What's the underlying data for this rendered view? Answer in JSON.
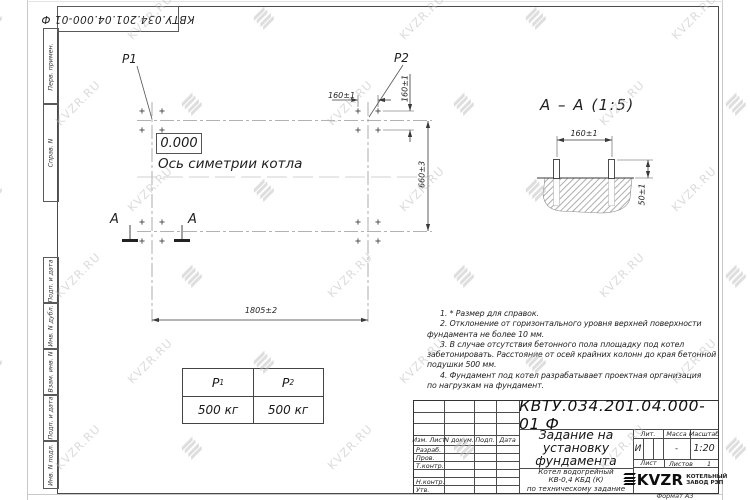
{
  "colors": {
    "paper": "#ffffff",
    "ink": "#3a3a3a",
    "centerline": "#999999",
    "watermark": "#bfbfbf"
  },
  "watermark": {
    "text": "KVZR.RU"
  },
  "edge_stamp": {
    "doc_number_rotated": "КВТУ.034.201.04.000-01 Ф"
  },
  "sidebar": {
    "labels": [
      "Перв. примен.",
      "Справ. N",
      "Подп. и дата",
      "Инв. N дубл.",
      "Взам. инв. N",
      "Подп. и дата",
      "Инв. N подл."
    ]
  },
  "plan_view": {
    "p1_label": "P1",
    "p2_label": "P2",
    "elevation": "0.000",
    "axis_label": "Ось симетрии котла",
    "dim_bolt_spacing_h": "160±1",
    "dim_bolt_spacing_v": "160±1",
    "dim_width": "660±3",
    "dim_length": "1805±2",
    "section_letter_left": "А",
    "section_letter_right": "А"
  },
  "section_view": {
    "title": "А – А (1:5)",
    "dim_bolt_spacing": "160±1",
    "dim_bolt_height": "50±1"
  },
  "notes_lines": [
    "1.  * Размер для справок.",
    "2.  Отклонение от горизонтального уровня верхней поверхности",
    "фундамента не более 10 мм.",
    "3.  В случае отсутствия бетонного пола площадку под котел",
    "забетонировать. Расстояние от осей крайних колонн до края бетонной",
    "подушки 500 мм.",
    "4.  Фундамент под котел разрабатывает проектная организация",
    "по нагрузкам на фундамент."
  ],
  "load_table": {
    "headers": [
      {
        "base": "P",
        "sub": "1"
      },
      {
        "base": "P",
        "sub": "2"
      }
    ],
    "values": [
      "500 кг",
      "500 кг"
    ]
  },
  "title_block": {
    "doc_number": "КВТУ.034.201.04.000-01 Ф",
    "title_lines": [
      "Задание на",
      "установку",
      "фундамента"
    ],
    "subtitle_lines": [
      "Котел водогрейный",
      "КВ-0,4  КБД  (К)",
      "по техническому задание"
    ],
    "header_cells": [
      "Изм. Лист",
      "N докум.",
      "Подп.",
      "Дата"
    ],
    "signature_rows": [
      "Разраб.",
      "Пров.",
      "Т.контр.",
      "",
      "Н.контр.",
      "Утв."
    ],
    "lit_label": "Лит.",
    "lit_value": "И",
    "mass_label": "Масса",
    "mass_value": "-",
    "scale_label": "Масштаб",
    "scale_value": "1:20",
    "sheet_label": "Лист",
    "sheets_label": "Листов",
    "sheets_value": "1",
    "logo_text": "KVZR",
    "company_lines": [
      "КОТЕЛЬНЫЙ",
      "ЗАВОД РЭП"
    ],
    "format_label": "Формат А3"
  }
}
